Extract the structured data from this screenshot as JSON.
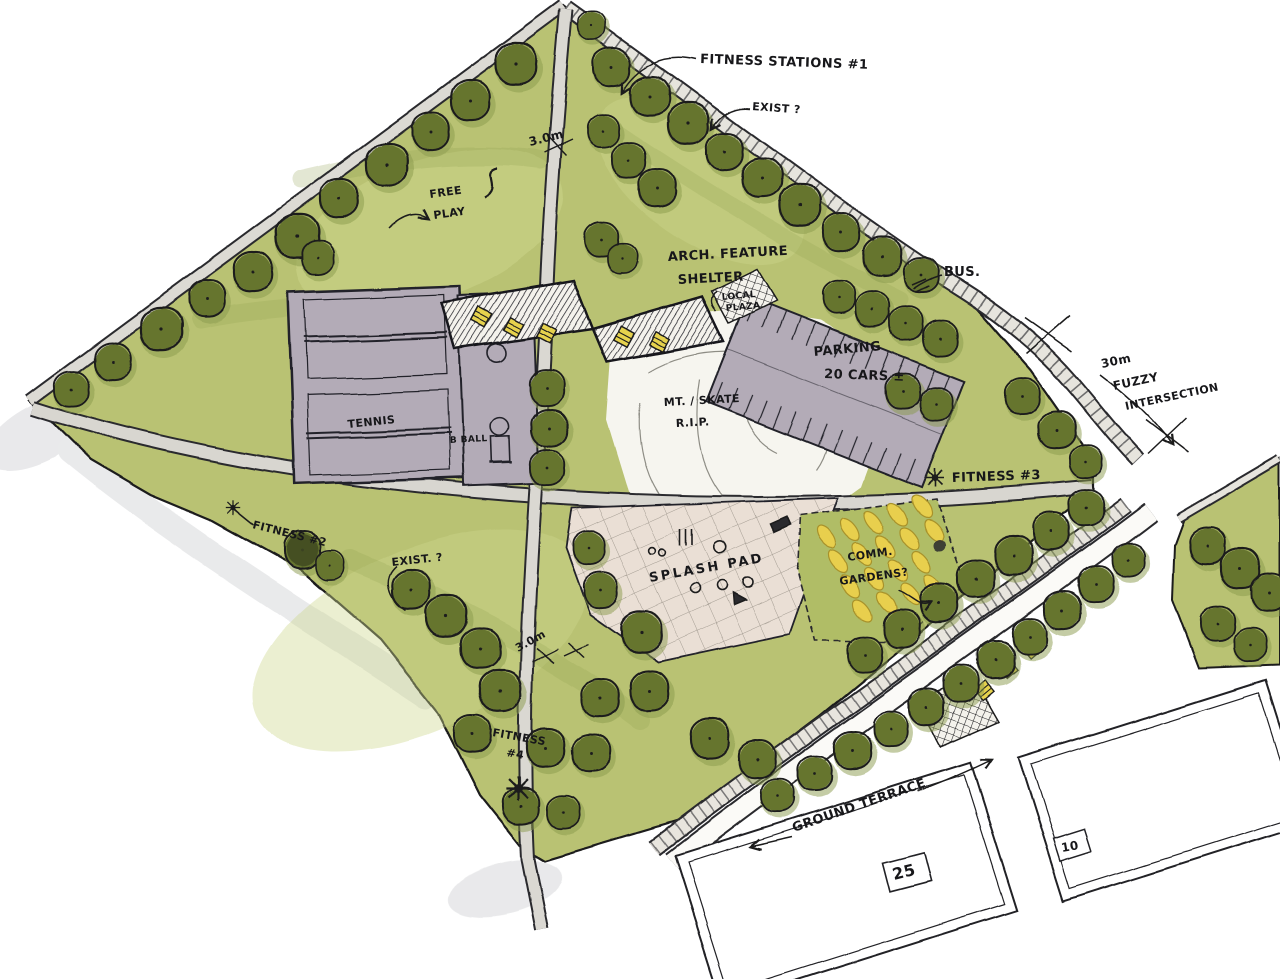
{
  "type": "hand-drawn landscape architecture concept plan of a neighbourhood park",
  "palette": {
    "paper": "#ffffff",
    "grass": "#b9c273",
    "grass_light": "#cdd68b",
    "tree_canopy": "#66742f",
    "tree_halo": "#8a9a4b",
    "court_grey": "#b3abb7",
    "path_grey": "#dad8d2",
    "plaza_pink": "#eadfd5",
    "garden_yellow": "#e8cf4e",
    "ink": "#1c1c1e",
    "pencil": "#8e8d85",
    "shade_grey": "#d7d8da"
  },
  "annotations": {
    "fitness_station_1": "FITNESS STATIONS #1",
    "exist_north": "EXIST ?",
    "path_width_north": "3.0m",
    "free_play_1": "FREE",
    "free_play_2": "PLAY",
    "shelter_1": "ARCH. FEATURE",
    "shelter_2": "SHELTER",
    "local_plaza_1": "LOCAL",
    "local_plaza_2": "PLAZA",
    "bus": "BUS.",
    "parking_1": "PARKING",
    "parking_2": "20 CARS ±",
    "fuzzy_1": "30m",
    "fuzzy_2": "FUZZY",
    "fuzzy_3": "INTERSECTION",
    "tennis": "TENNIS",
    "basketball": "B BALL",
    "mound_1": "MT. / SKATE",
    "mound_2": "R.I.P.",
    "fitness_3": "FITNESS #3",
    "fitness_2": "FITNESS #2",
    "exist_west": "EXIST. ?",
    "splash_pad": "SPLASH PAD",
    "gardens_1": "COMM.",
    "gardens_2": "GARDENS?",
    "path_width_south": "3.0m",
    "fitness_4_1": "FITNESS",
    "fitness_4_2": "#4",
    "ground_terrace": "GROUND TERRACE",
    "stall_count_west": "25",
    "stall_count_east": "10"
  },
  "symbols": [
    {
      "layer": "trees",
      "ref": "tree",
      "name": "tree-icon",
      "rot": 0,
      "items": [
        [
          592,
          26,
          0.7
        ],
        [
          516,
          64,
          1
        ],
        [
          470,
          101,
          0.95
        ],
        [
          430,
          132,
          0.9
        ],
        [
          387,
          165,
          1
        ],
        [
          339,
          199,
          0.95
        ],
        [
          297,
          237,
          1.05
        ],
        [
          318,
          258,
          0.8
        ],
        [
          253,
          272,
          0.95
        ],
        [
          207,
          299,
          0.9
        ],
        [
          161,
          329,
          1
        ],
        [
          113,
          361,
          0.9
        ],
        [
          72,
          389,
          0.85
        ],
        [
          612,
          67,
          0.9
        ],
        [
          650,
          96,
          0.95
        ],
        [
          688,
          124,
          1
        ],
        [
          725,
          152,
          0.9
        ],
        [
          762,
          179,
          0.95
        ],
        [
          800,
          206,
          1
        ],
        [
          841,
          233,
          0.9
        ],
        [
          882,
          257,
          0.95
        ],
        [
          921,
          276,
          0.85
        ],
        [
          603,
          131,
          0.8
        ],
        [
          629,
          160,
          0.85
        ],
        [
          657,
          188,
          0.9
        ],
        [
          602,
          239,
          0.85
        ],
        [
          624,
          259,
          0.75
        ],
        [
          838,
          297,
          0.8
        ],
        [
          872,
          310,
          0.85
        ],
        [
          906,
          324,
          0.8
        ],
        [
          940,
          338,
          0.85
        ],
        [
          902,
          392,
          0.85
        ],
        [
          936,
          404,
          0.8
        ],
        [
          1022,
          396,
          0.85
        ],
        [
          1057,
          430,
          0.9
        ],
        [
          1086,
          462,
          0.8
        ],
        [
          546,
          388,
          0.85
        ],
        [
          549,
          428,
          0.9
        ],
        [
          547,
          468,
          0.85
        ],
        [
          589,
          548,
          0.8
        ],
        [
          601,
          590,
          0.85
        ],
        [
          641,
          632,
          1
        ],
        [
          649,
          691,
          0.95
        ],
        [
          600,
          699,
          0.9
        ],
        [
          546,
          747,
          0.95
        ],
        [
          591,
          754,
          0.9
        ],
        [
          710,
          739,
          0.95
        ],
        [
          757,
          760,
          0.9
        ],
        [
          1086,
          508,
          0.85
        ],
        [
          1051,
          532,
          0.9
        ],
        [
          1013,
          556,
          0.95
        ],
        [
          976,
          580,
          0.9
        ],
        [
          939,
          604,
          0.95
        ],
        [
          901,
          629,
          0.9
        ],
        [
          864,
          654,
          0.85
        ],
        [
          1128,
          560,
          0.8
        ],
        [
          1096,
          584,
          0.85
        ],
        [
          1063,
          610,
          0.9
        ],
        [
          1030,
          636,
          0.85
        ],
        [
          996,
          660,
          0.9
        ],
        [
          962,
          684,
          0.85
        ],
        [
          927,
          707,
          0.9
        ],
        [
          890,
          729,
          0.85
        ],
        [
          852,
          751,
          0.9
        ],
        [
          814,
          774,
          0.85
        ],
        [
          777,
          796,
          0.8
        ],
        [
          302,
          551,
          0.9
        ],
        [
          330,
          566,
          0.7
        ],
        [
          411,
          590,
          0.95
        ],
        [
          447,
          617,
          1
        ],
        [
          481,
          649,
          0.95
        ],
        [
          501,
          691,
          1
        ],
        [
          473,
          734,
          0.9
        ],
        [
          521,
          806,
          0.9
        ],
        [
          563,
          812,
          0.8
        ],
        [
          1207,
          546,
          0.9
        ],
        [
          1240,
          569,
          0.95
        ],
        [
          1269,
          593,
          0.9
        ],
        [
          1217,
          624,
          0.85
        ],
        [
          1250,
          645,
          0.8
        ]
      ]
    },
    {
      "layer": "shelter-tables",
      "ref": "ptable",
      "name": "picnic-table-icon",
      "rot": 28,
      "items": [
        [
          482,
          318,
          0.95
        ],
        [
          513,
          327,
          0.9
        ],
        [
          546,
          333,
          0.95
        ],
        [
          624,
          337,
          0.95
        ],
        [
          659,
          342,
          0.9
        ]
      ]
    },
    {
      "layer": "terrace-tables",
      "ref": "ptable",
      "name": "picnic-table-icon",
      "rot": -40,
      "items": [
        [
          985,
          690,
          0.85
        ],
        [
          1008,
          668,
          0.85
        ],
        [
          1031,
          648,
          0.85
        ]
      ]
    },
    {
      "layer": "garden-plots",
      "ref": "plot",
      "name": "garden-plot-icon",
      "rot": 0,
      "items": [
        [
          826,
          538,
          1
        ],
        [
          850,
          530,
          1
        ],
        [
          874,
          522,
          1
        ],
        [
          898,
          514,
          1
        ],
        [
          922,
          506,
          1
        ],
        [
          838,
          562,
          1
        ],
        [
          862,
          554,
          1
        ],
        [
          886,
          546,
          1
        ],
        [
          910,
          538,
          1
        ],
        [
          934,
          530,
          1
        ],
        [
          850,
          586,
          1
        ],
        [
          874,
          578,
          1
        ],
        [
          898,
          570,
          1
        ],
        [
          922,
          562,
          1
        ],
        [
          862,
          610,
          1
        ],
        [
          886,
          602,
          1
        ],
        [
          910,
          594,
          1
        ],
        [
          934,
          586,
          1
        ]
      ]
    },
    {
      "layer": "fitness-icons",
      "ref": "spider",
      "name": "fitness-station-icon",
      "rot": 0,
      "items": [
        [
          935,
          478,
          1
        ],
        [
          233,
          508,
          0.8
        ],
        [
          518,
          788,
          1.35
        ]
      ]
    }
  ]
}
